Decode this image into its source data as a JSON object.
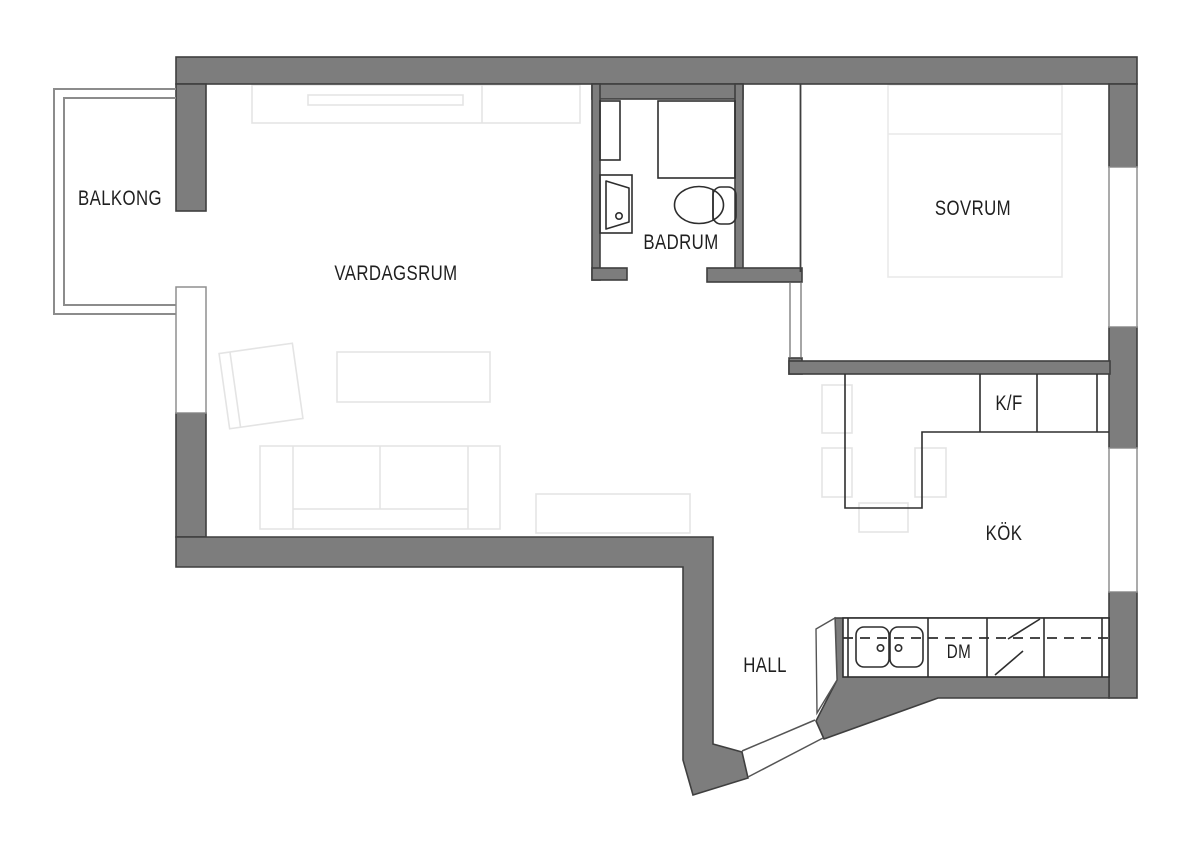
{
  "rooms": {
    "balkong": {
      "label": "BALKONG"
    },
    "vardagsrum": {
      "label": "VARDAGSRUM"
    },
    "badrum": {
      "label": "BADRUM"
    },
    "sovrum": {
      "label": "SOVRUM"
    },
    "kok": {
      "label": "KÖK"
    },
    "hall": {
      "label": "HALL"
    }
  },
  "appliances": {
    "fridge_freezer": {
      "label": "K/F"
    },
    "dishwasher": {
      "label": "DM"
    }
  },
  "colors": {
    "background": "#ffffff",
    "wall": "#7d7d7d",
    "wall_outline": "#3f3f3f",
    "fixture_line": "#2e2e2e",
    "furniture_line": "#e4e4e4",
    "balcony_line": "#8c8c8c",
    "window_frame": "#8f8f8f",
    "door_line": "#555555",
    "text": "#1f1f1f"
  }
}
